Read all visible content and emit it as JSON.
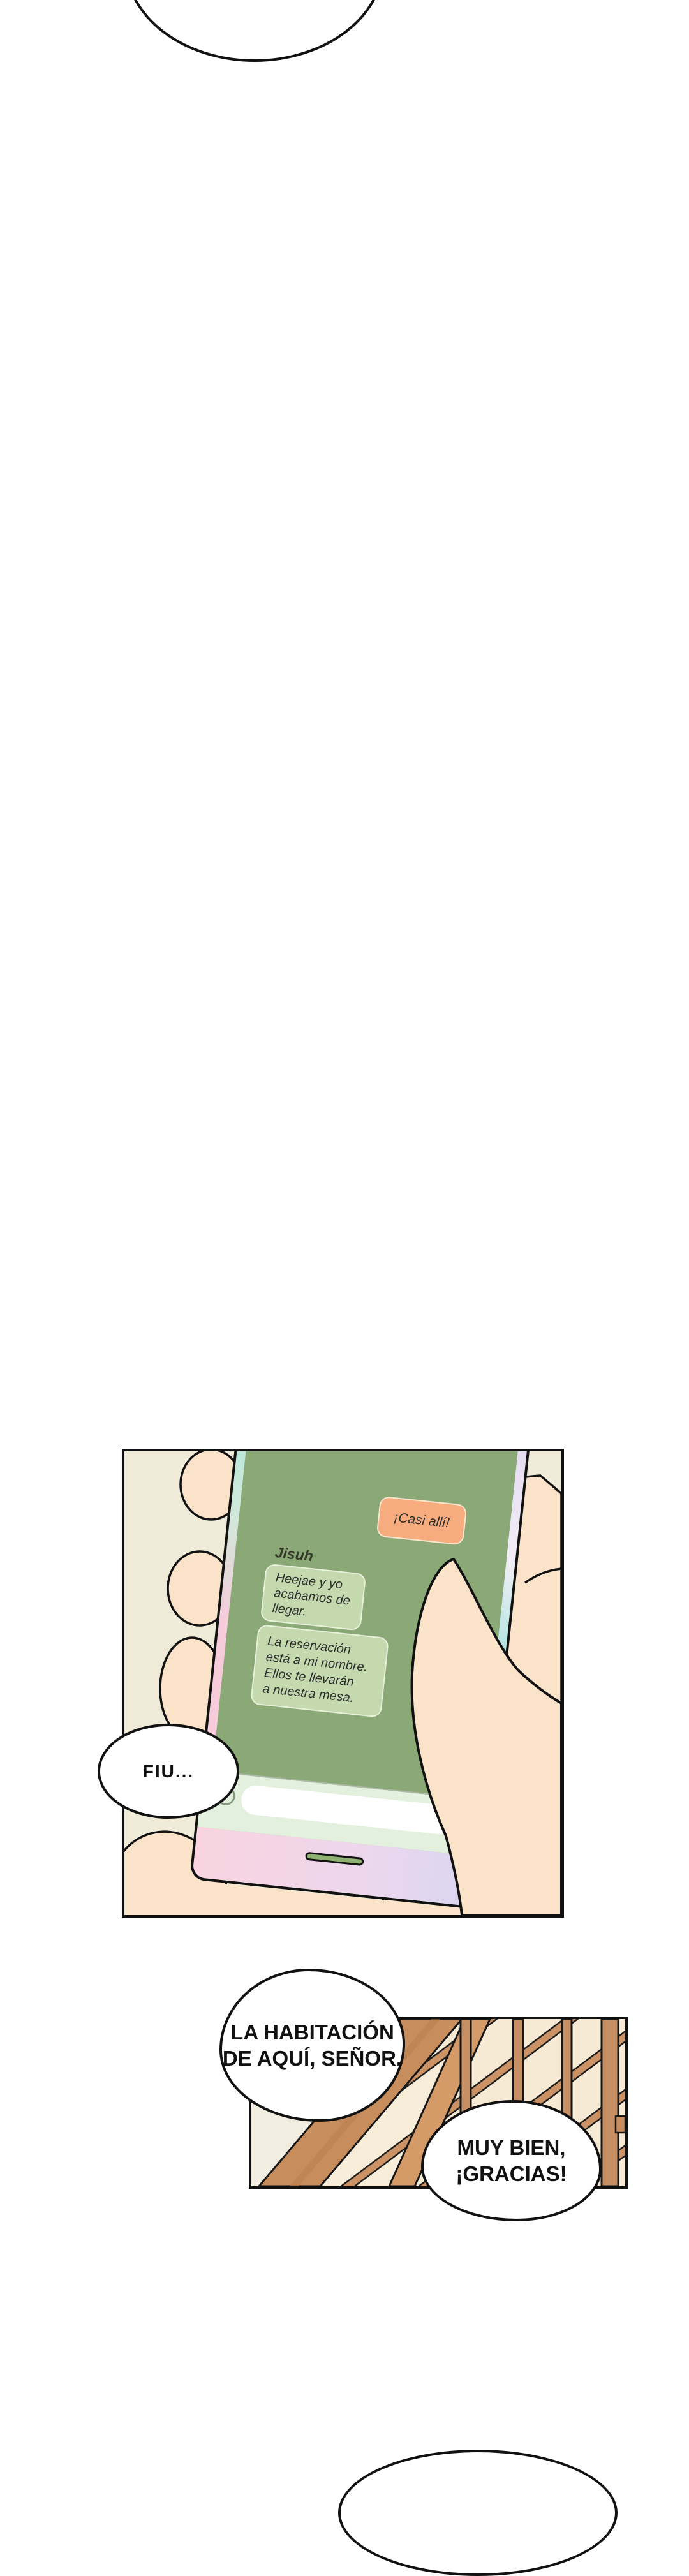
{
  "page": {
    "type": "webtoon-episode-segment",
    "background": "#ffffff"
  },
  "palette": {
    "outline": "#111111",
    "panel_bg_cream": "#f0ebd8",
    "screen_green": "#8ba877",
    "sent_bubble_orange": "#f6ac7e",
    "received_bubble_green": "#c4d9ae",
    "keyboard_area": "#e2f0dd",
    "phone_edge_cyan": "#a9e2da",
    "phone_edge_pink": "#f6cbda",
    "phone_edge_lavender": "#e3d8f1",
    "bezel_pink": "#f9d3df",
    "bezel_lavender": "#d9d6f2",
    "home_slot_green": "#8fb171",
    "skin": "#fae3c8",
    "wood": "#c88d5c",
    "wood_light": "#d49b68",
    "stairs_bg": "#f8edd9"
  },
  "phone_panel": {
    "chat": {
      "contact_name": "Jisuh",
      "sent_message": "¡Casi allí!",
      "received_message_1": "Heejae y yo\nacabamos de\nllegar.",
      "received_message_2": "La reservación\nestá a mi nombre.\nEllos te llevarán\na nuestra mesa."
    },
    "sfx_bubble": "FIU..."
  },
  "stairs_panel": {
    "bubble_bellboy": "LA HABITACIÓN\nDE AQUÍ, SEÑOR.",
    "bubble_guest": "MUY BIEN,\n¡GRACIAS!"
  }
}
